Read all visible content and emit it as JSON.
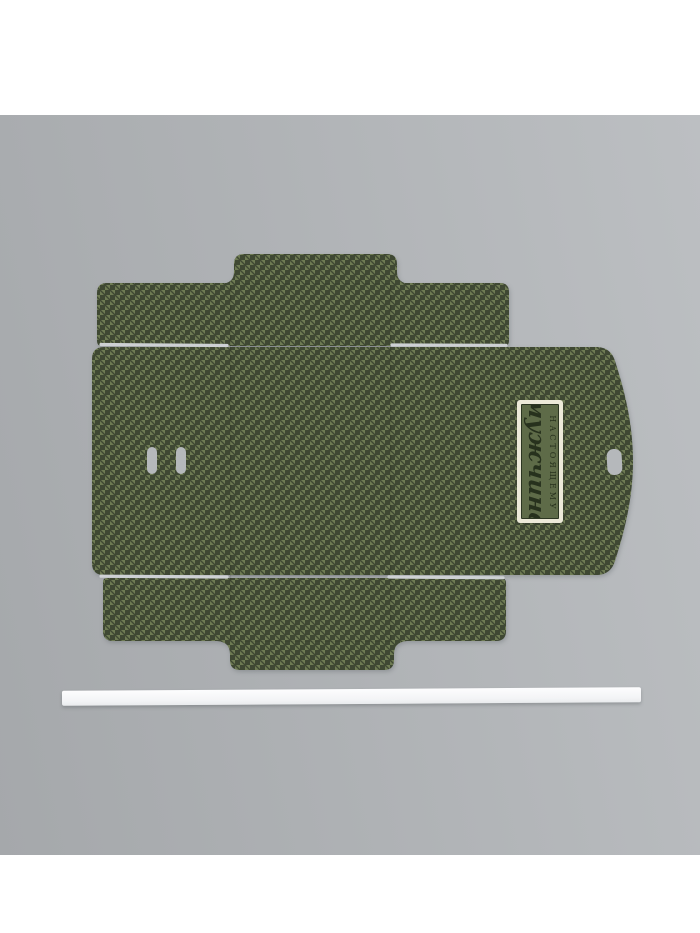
{
  "label": {
    "top_text": "НАСТОЯЩЕМУ",
    "main_text": "мужчине"
  },
  "colors": {
    "backdrop_light": "#bcbfc2",
    "backdrop_mid": "#afb2b5",
    "backdrop_dark": "#a5a8ab",
    "pattern_dark": "#3f4833",
    "pattern_light": "#6e7b53",
    "label_frame": "#ece9d8",
    "label_bg": "#5e6b48",
    "label_border_line": "#2c3622",
    "label_text": "#27311d",
    "paper_strip": "#f7f8f9",
    "slit_gap": "#ced1d4",
    "handle_slot": "#b5b8bb"
  }
}
